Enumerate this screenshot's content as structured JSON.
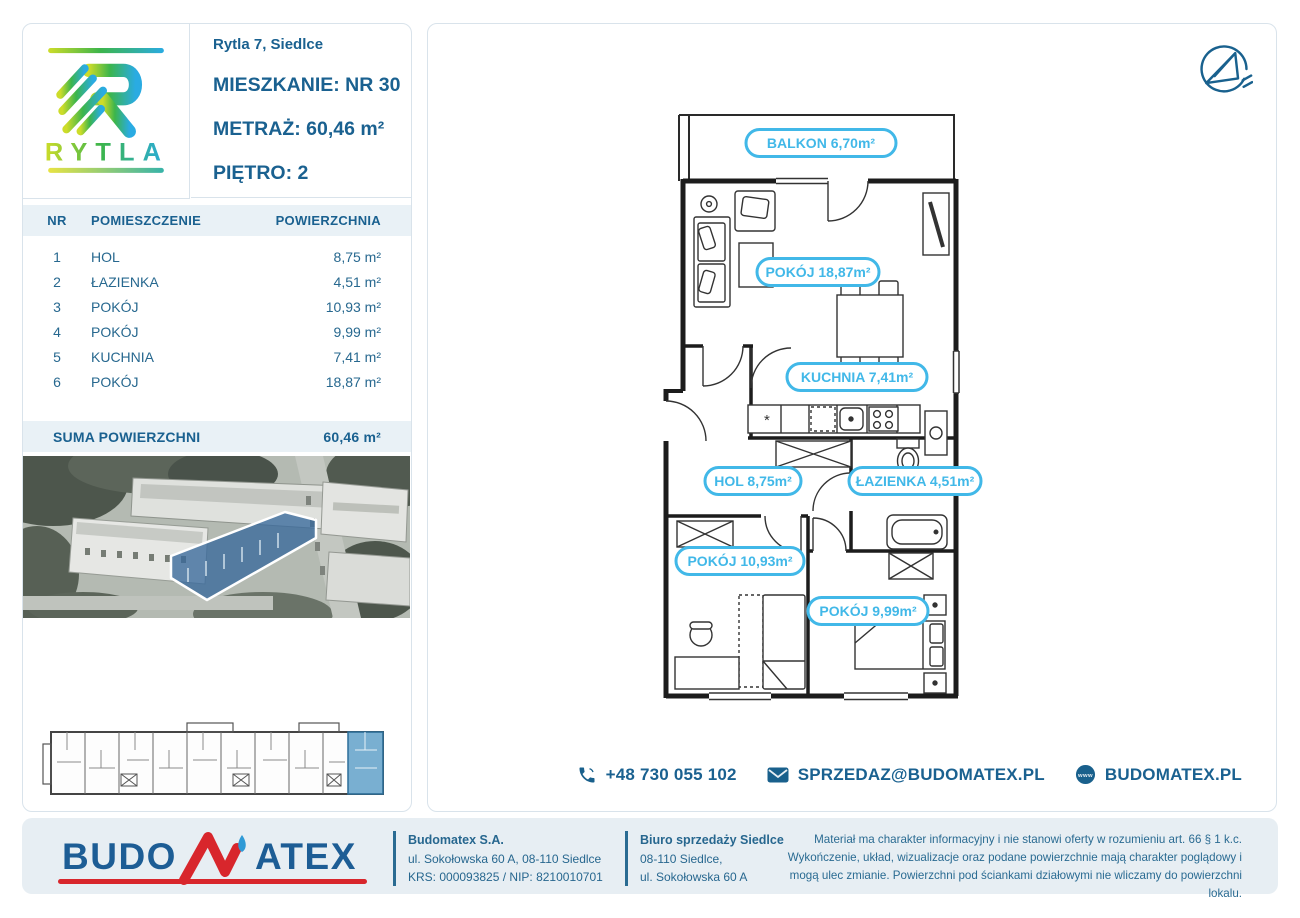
{
  "logo": {
    "brand": "RYTLA"
  },
  "header": {
    "address": "Rytla 7, Siedlce",
    "apartment_label": "MIESZKANIE:",
    "apartment_value": "NR 30",
    "area_label": "METRAŻ:",
    "area_value": "60,46 m²",
    "floor_label": "PIĘTRO:",
    "floor_value": "2"
  },
  "rooms_table": {
    "headers": [
      "NR",
      "POMIESZCZENIE",
      "POWIERZCHNIA"
    ],
    "rows": [
      {
        "nr": "1",
        "name": "HOL",
        "area": "8,75 m²"
      },
      {
        "nr": "2",
        "name": "ŁAZIENKA",
        "area": "4,51 m²"
      },
      {
        "nr": "3",
        "name": "POKÓJ",
        "area": "10,93 m²"
      },
      {
        "nr": "4",
        "name": "POKÓJ",
        "area": "9,99 m²"
      },
      {
        "nr": "5",
        "name": "KUCHNIA",
        "area": "7,41 m²"
      },
      {
        "nr": "6",
        "name": "POKÓJ",
        "area": "18,87 m²"
      }
    ],
    "sum_label": "SUMA POWIERZCHNI",
    "sum_value": "60,46 m²"
  },
  "floor_plan": {
    "labels": {
      "balkon": "BALKON 6,70m²",
      "pokoj6": "POKÓJ 18,87m²",
      "kuchnia": "KUCHNIA 7,41m²",
      "hol": "HOL 8,75m²",
      "lazienka": "ŁAZIENKA 4,51m²",
      "pokoj3": "POKÓJ 10,93m²",
      "pokoj4": "POKÓJ 9,99m²"
    }
  },
  "contact": {
    "phone": "+48 730 055 102",
    "email": "SPRZEDAZ@BUDOMATEX.PL",
    "website": "BUDOMATEX.PL"
  },
  "footer": {
    "logo": {
      "part1": "BUDO",
      "part2": "ATEX"
    },
    "company": {
      "name": "Budomatex S.A.",
      "address": "ul. Sokołowska 60 A, 08-110 Siedlce",
      "ids": "KRS: 000093825 / NIP: 8210010701"
    },
    "office": {
      "name": "Biuro sprzedaży Siedlce",
      "line1": "08-110 Siedlce,",
      "line2": "ul. Sokołowska 60 A"
    },
    "disclaimer": "Materiał ma charakter informacyjny i nie stanowi oferty w rozumieniu art. 66 § 1 k.c. Wykończenie, układ, wizualizacje oraz podane powierzchnie mają charakter poglądowy i mogą ulec zmianie. Powierzchni pod ściankami działowymi nie wliczamy do powierzchni lokalu."
  },
  "colors": {
    "primary": "#1a6190",
    "accent_cyan": "#41b8e8",
    "band": "#e9f1f6",
    "card_border": "#d9e3eb",
    "footer_bg": "#e7eef3",
    "logo_red": "#d8262c",
    "logo_blue": "#1d5d95",
    "highlight_building": "#38699b"
  }
}
